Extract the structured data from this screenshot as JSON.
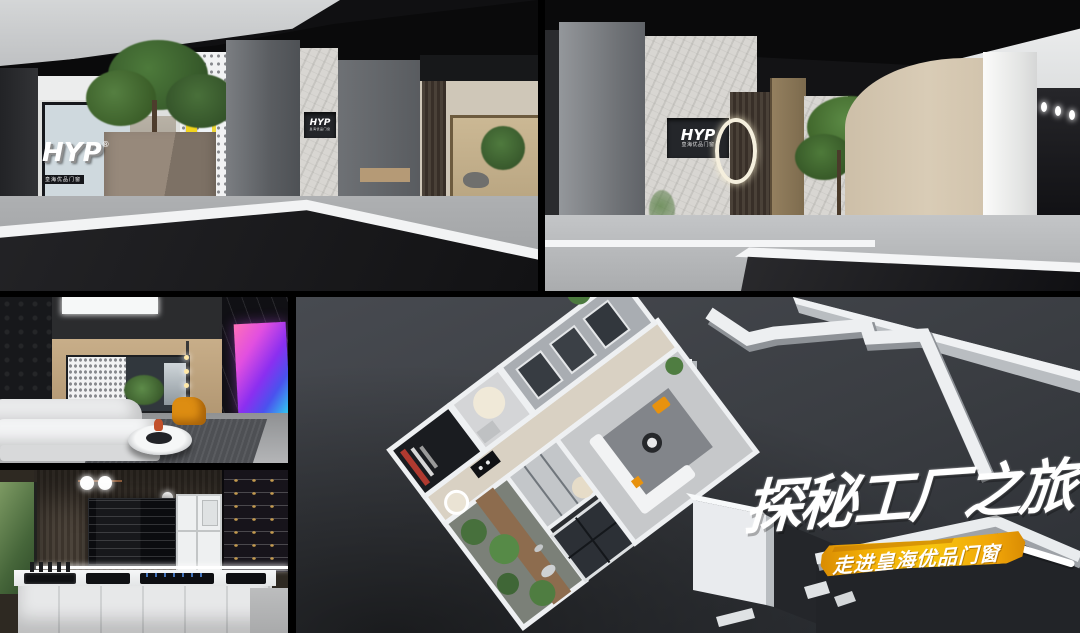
{
  "overlay": {
    "headline": "探秘工厂之旅",
    "subline": "走进皇海优品门窗",
    "banner_color": "#f2a90a",
    "headline_color": "#ffffff"
  },
  "brand": {
    "logo": "HYP",
    "logo_registered": "®",
    "logo_subtext": "皇海优品门窗"
  },
  "colors": {
    "background": "#000000",
    "poster_yellow": "#f2d41c",
    "accent_orange": "#e8920e",
    "floor_dark": "#33363b",
    "marble_light": "#d8d6d2",
    "tv_screen_gradient": [
      "#ff5fa2",
      "#8b2ff0",
      "#2fd4f0"
    ]
  }
}
